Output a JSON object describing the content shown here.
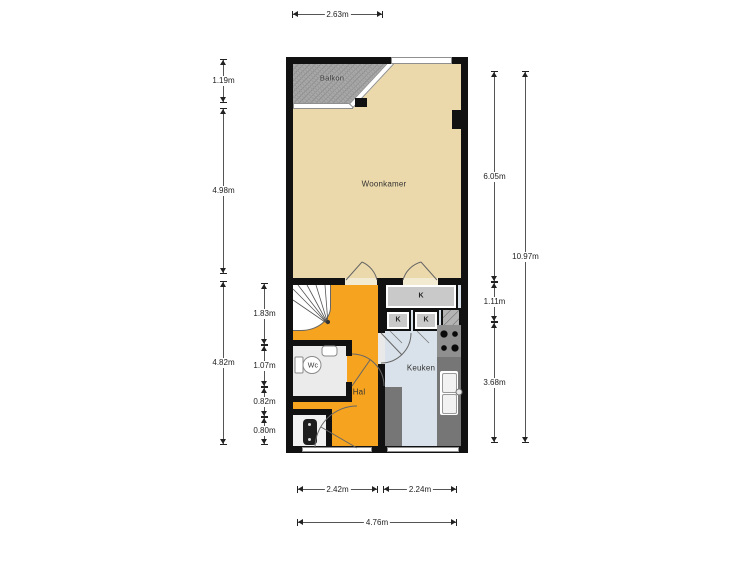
{
  "plan": {
    "room_labels": {
      "balkon": "Balkon",
      "woonkamer": "Woonkamer",
      "hal": "Hal",
      "wc": "Wc",
      "keuken": "Keuken"
    },
    "closet_labels": {
      "large": "K",
      "small_left": "K",
      "small_right": "K"
    }
  },
  "dimensions": {
    "balkon_width": "2.63m",
    "balkon_depth": "1.19m",
    "woonkamer_left_height": "4.98m",
    "lower_left_height": "4.82m",
    "stairs_height": "1.83m",
    "wc_height": "1.07m",
    "hal_segment": "0.82m",
    "meter_closet_height": "0.80m",
    "woonkamer_right_height": "6.05m",
    "closet_row_height": "1.11m",
    "keuken_height": "3.68m",
    "total_height": "10.97m",
    "hal_width": "2.42m",
    "keuken_width": "2.24m",
    "total_width": "4.76m"
  },
  "colors": {
    "wall": "#111111",
    "woonkamer_floor": "#ecd9ab",
    "hal_floor": "#f6a31f",
    "keuken_floor": "#d9e2ea",
    "balkon_floor": "#a8a8a8",
    "closet": "#c9c9c9",
    "counter": "#767676",
    "stove": "#8f8f8f"
  }
}
